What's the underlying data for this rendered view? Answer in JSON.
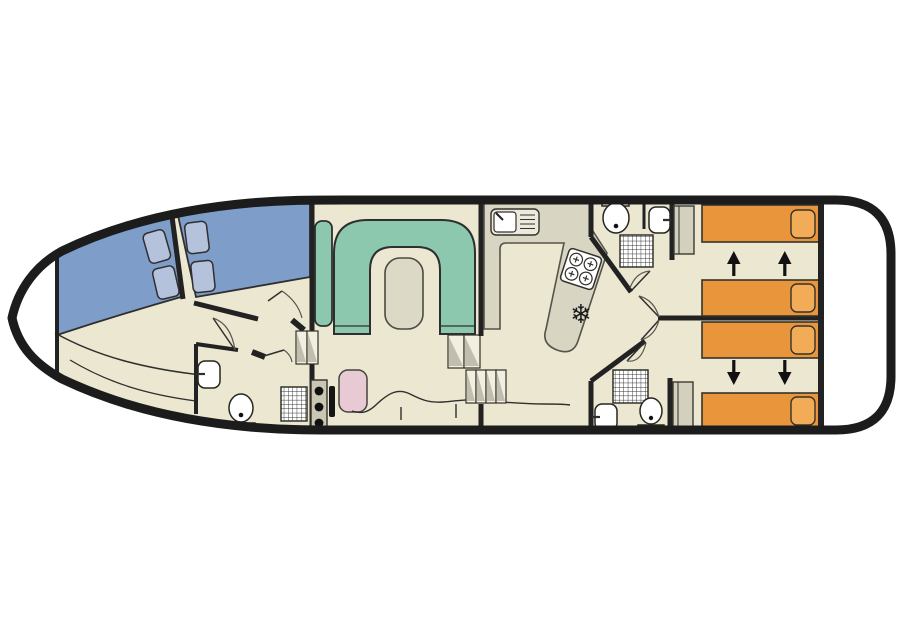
{
  "colors": {
    "hull": "#1c1c1c",
    "deck": "#ffffff",
    "floor": "#ebe7d1",
    "wall": "#222222",
    "line": "#2f2f2f",
    "door_arc": "#5a574e",
    "bed_blue": "#7e9dc8",
    "pillow_blue": "#b5c2dc",
    "sofa_green": "#8cc8ae",
    "table_gray": "#dcd9c7",
    "counter_gray": "#d8d5c3",
    "bed_orange": "#e9953c",
    "pillow_orange": "#f2ab57",
    "seat_pink": "#e7cad4",
    "wardrobe_gray": "#d3d0be",
    "console_gray": "#c9c6b4",
    "steps_fill": "#f2efe0",
    "steps_shade": "#b4b1a3",
    "fixture": "#ffffff"
  },
  "icons": {
    "freezer_snowflake": "❄"
  }
}
